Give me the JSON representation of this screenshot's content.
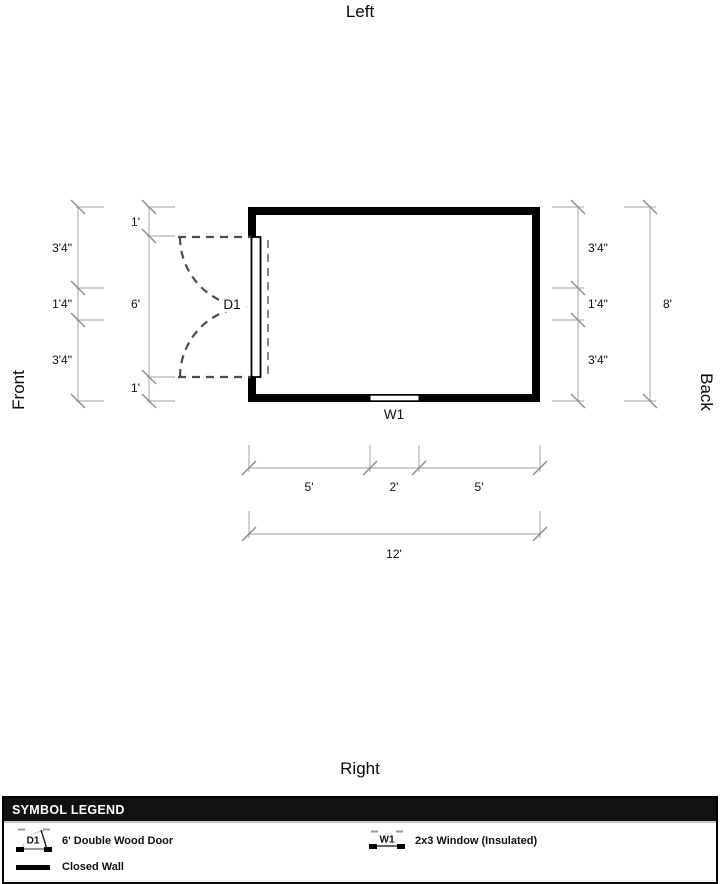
{
  "orientation": {
    "top": "Left",
    "bottom": "Right",
    "left": "Front",
    "right": "Back"
  },
  "plan": {
    "door": {
      "id": "D1"
    },
    "window": {
      "id": "W1"
    },
    "dims": {
      "left_outer": {
        "segments": [
          "3'4\"",
          "1'4\"",
          "3'4\""
        ]
      },
      "left_inner": {
        "segments": [
          "1'",
          "6'",
          "1'"
        ]
      },
      "right_inner": {
        "segments": [
          "3'4\"",
          "1'4\"",
          "3'4\""
        ]
      },
      "right_outer": {
        "total": "8'"
      },
      "bottom_inner": {
        "segments": [
          "5'",
          "2'",
          "5'"
        ]
      },
      "bottom_outer": {
        "total": "12'"
      }
    }
  },
  "legend": {
    "title": "SYMBOL LEGEND",
    "items": [
      {
        "symbol": "D1",
        "label": "6' Double Wood Door"
      },
      {
        "symbol": "W1",
        "label": "2x3 Window (Insulated)"
      },
      {
        "symbol": "closed-wall",
        "label": "Closed Wall"
      }
    ]
  },
  "colors": {
    "wall": "#000000",
    "dim_line": "#b3b3b3",
    "tick": "#8c8c8c",
    "door_dash": "#4d4d4d",
    "legend_header_bg": "#111111",
    "legend_header_text": "#ffffff"
  }
}
